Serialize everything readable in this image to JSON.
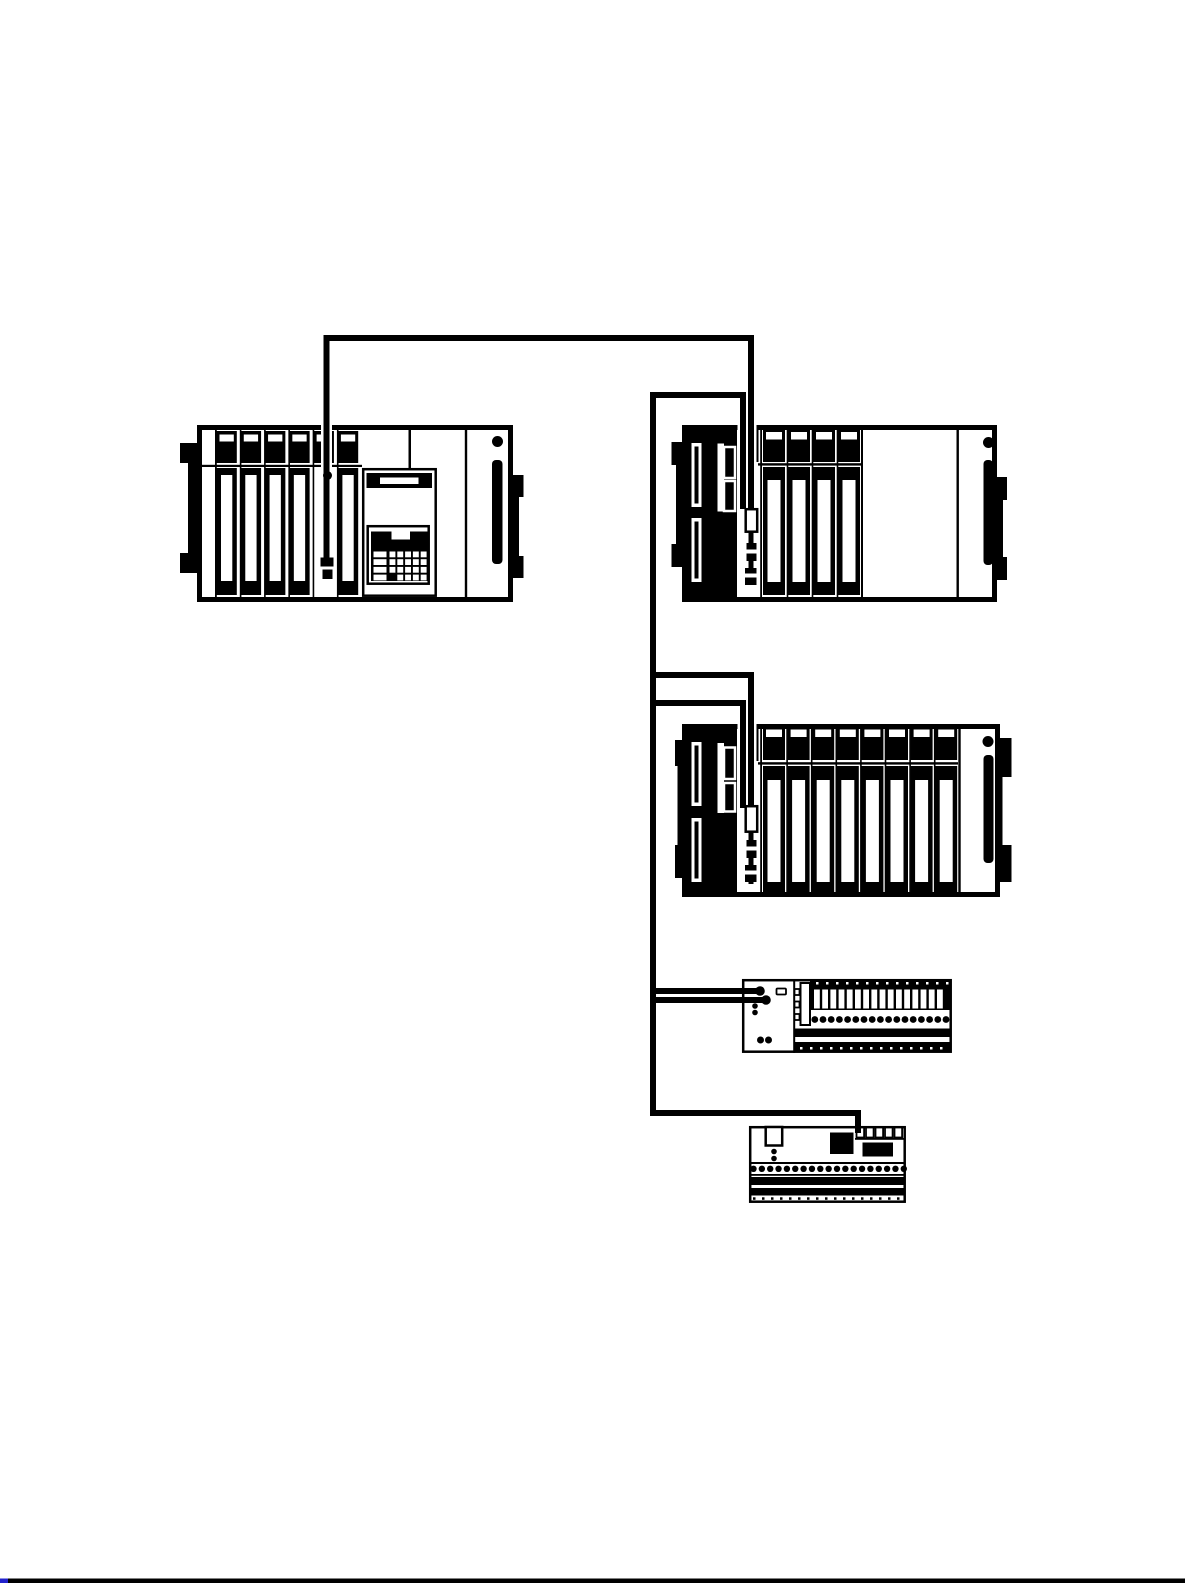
{
  "canvas": {
    "w": 1193,
    "h": 1585,
    "bg": "#ffffff",
    "ink": "#000000",
    "accent_blue": "#2222cc"
  },
  "figure": {
    "kind": "plc-network-wiring-diagram",
    "topology": "daisy-chain",
    "devices": [
      {
        "name": "plc-rack-with-programming-console",
        "module_slots": 6,
        "has_keypad": true,
        "has_display": true
      },
      {
        "name": "plc-expansion-rack-a",
        "module_slots": 4,
        "has_cpu_block": true
      },
      {
        "name": "plc-expansion-rack-b",
        "module_slots": 8,
        "has_cpu_block": true
      },
      {
        "name": "remote-io-terminal-block",
        "terminal_slots": 16,
        "terminal_screws": 17,
        "connection_terminals": 2
      },
      {
        "name": "remote-io-relay-board",
        "top_terminals": 5,
        "terminal_screws": 19
      }
    ],
    "cable_connection_dots": 3,
    "page_rule": {
      "color": "#000000",
      "left_tip_color": "#2222cc"
    }
  },
  "render_jobs": [
    {
      "target": "g-rack1-gen",
      "name": "slot-divider",
      "kind": "rects",
      "x0": 239.8,
      "y0": 430,
      "dx": 24.28,
      "count": 5,
      "w": 1.6,
      "h": 167
    },
    {
      "target": "g-rack1-gen",
      "name": "io-module-top",
      "kind": "rects",
      "x0": 216.5,
      "y0": 431,
      "dx": 24.28,
      "count": 6,
      "w": 20.3,
      "h": 32
    },
    {
      "target": "g-rack1-gen",
      "name": "io-module-top-label",
      "kind": "rects",
      "x0": 219.5,
      "y0": 434.5,
      "dx": 24.28,
      "count": 6,
      "w": 14.3,
      "h": 7,
      "fill": "#ffffff"
    },
    {
      "target": "g-rack1-gen",
      "name": "io-module-card",
      "kind": "rects",
      "x0": 216.5,
      "y0": 468,
      "dx": 24.28,
      "count": 6,
      "w": 20.3,
      "h": 127,
      "skip": [
        4
      ]
    },
    {
      "target": "g-rack1-gen",
      "name": "io-module-card-stripe",
      "kind": "rects",
      "x0": 221,
      "y0": 475,
      "dx": 24.28,
      "count": 6,
      "w": 11.3,
      "h": 106,
      "fill": "#ffffff",
      "skip": [
        4
      ]
    },
    {
      "target": "g-rack1-keys",
      "name": "keypad-key-wide",
      "kind": "rects",
      "x0": 373.5,
      "y0": 551.5,
      "dy": 7.7,
      "count": 4,
      "w": 13,
      "h": 5.8,
      "fill": "#ffffff"
    },
    {
      "target": "g-rack1-keys",
      "name": "keypad-key",
      "kind": "rects",
      "x0": 389.5,
      "y0": 551.5,
      "dx": 7.8,
      "count": 5,
      "w": 5.9,
      "h": 5.8,
      "fill": "#ffffff"
    },
    {
      "target": "g-rack1-keys",
      "name": "keypad-key",
      "kind": "rects",
      "x0": 389.5,
      "y0": 559.2,
      "dx": 7.8,
      "count": 5,
      "w": 5.9,
      "h": 5.8,
      "fill": "#ffffff"
    },
    {
      "target": "g-rack1-keys",
      "name": "keypad-key",
      "kind": "rects",
      "x0": 389.5,
      "y0": 566.9,
      "dx": 7.8,
      "count": 5,
      "w": 5.9,
      "h": 5.8,
      "fill": "#ffffff"
    },
    {
      "target": "g-rack1-keys",
      "name": "keypad-key",
      "kind": "rects",
      "x0": 389.5,
      "y0": 574.6,
      "dx": 7.8,
      "count": 5,
      "w": 5.9,
      "h": 5.8,
      "fill": "#ffffff",
      "skip": [
        0
      ]
    },
    {
      "target": "g-rack2-gen",
      "name": "slot-divider",
      "kind": "rects",
      "x0": 786.7,
      "y0": 430,
      "dx": 25,
      "count": 3,
      "w": 1.6,
      "h": 167
    },
    {
      "target": "g-rack2-gen",
      "name": "io-module-top",
      "kind": "rects",
      "x0": 763,
      "y0": 429.5,
      "dx": 25,
      "count": 4,
      "w": 22,
      "h": 32.5
    },
    {
      "target": "g-rack2-gen",
      "name": "io-module-top-label",
      "kind": "rects",
      "x0": 766,
      "y0": 432,
      "dx": 25,
      "count": 4,
      "w": 16,
      "h": 7.5,
      "fill": "#ffffff"
    },
    {
      "target": "g-rack2-gen",
      "name": "io-module-card",
      "kind": "rects",
      "x0": 763,
      "y0": 467,
      "dx": 25,
      "count": 4,
      "w": 22,
      "h": 128
    },
    {
      "target": "g-rack2-gen",
      "name": "io-module-card-stripe",
      "kind": "rects",
      "x0": 767.5,
      "y0": 480,
      "dx": 25,
      "count": 4,
      "w": 13,
      "h": 102,
      "fill": "#ffffff"
    },
    {
      "target": "g-rack3-gen",
      "name": "slot-divider",
      "kind": "rects",
      "x0": 786.3,
      "y0": 727,
      "dx": 24.6,
      "count": 7,
      "w": 1.6,
      "h": 166
    },
    {
      "target": "g-rack3-gen",
      "name": "io-module-top",
      "kind": "rects",
      "x0": 763,
      "y0": 726.5,
      "dx": 24.6,
      "count": 8,
      "w": 22,
      "h": 33.5
    },
    {
      "target": "g-rack3-gen",
      "name": "io-module-top-label",
      "kind": "rects",
      "x0": 766,
      "y0": 729.5,
      "dx": 24.6,
      "count": 8,
      "w": 16,
      "h": 7.5,
      "fill": "#ffffff"
    },
    {
      "target": "g-rack3-gen",
      "name": "io-module-card",
      "kind": "rects",
      "x0": 763,
      "y0": 766,
      "dx": 24.6,
      "count": 8,
      "w": 22,
      "h": 127
    },
    {
      "target": "g-rack3-gen",
      "name": "io-module-card-stripe",
      "kind": "rects",
      "x0": 767.5,
      "y0": 780,
      "dx": 24.6,
      "count": 8,
      "w": 13,
      "h": 102,
      "fill": "#ffffff"
    },
    {
      "target": "g-io-gen",
      "name": "terminal-slot",
      "kind": "rects",
      "x0": 814,
      "y0": 989.5,
      "dx": 8.2,
      "count": 16,
      "w": 5.8,
      "h": 19,
      "fill": "#ffffff"
    },
    {
      "target": "g-io-gen",
      "name": "tick-mark",
      "kind": "rects",
      "x0": 816,
      "y0": 982,
      "dx": 10,
      "count": 14,
      "w": 2.5,
      "h": 2.5,
      "fill": "#ffffff"
    },
    {
      "target": "g-io-gen",
      "name": "terminal-screw",
      "kind": "circles",
      "x0": 814.8,
      "cy": 1019.5,
      "dx": 8.2,
      "count": 17,
      "r": 3.4
    },
    {
      "target": "g-io-gen",
      "name": "tick-mark",
      "kind": "rects",
      "x0": 800,
      "y0": 1047,
      "dx": 10,
      "count": 15,
      "w": 2.5,
      "h": 2.5,
      "fill": "#ffffff"
    },
    {
      "target": "g-bd-gen",
      "name": "terminal-box",
      "kind": "rects",
      "x0": 856.5,
      "y0": 1127.5,
      "dx": 9.5,
      "count": 5,
      "w": 7.6,
      "h": 10,
      "fill": "#ffffff",
      "stroke": "#000000",
      "sw": 1.8
    },
    {
      "target": "g-bd-gen",
      "name": "terminal-screw",
      "kind": "circles",
      "x0": 753.5,
      "cy": 1168.8,
      "dx": 8.35,
      "count": 19,
      "r": 3.2
    },
    {
      "target": "g-bd-gen",
      "name": "tick-mark",
      "kind": "rects",
      "x0": 753,
      "y0": 1197.3,
      "dx": 9,
      "count": 17,
      "w": 2.5,
      "h": 2.5
    },
    {
      "target": "g-wires-under",
      "name": "cable-halo",
      "kind": "wires",
      "sw": 11,
      "lines": [
        {
          "pts": [
            [
              326.5,
              424
            ],
            [
              326.5,
              561
            ]
          ],
          "color": "#ffffff"
        },
        {
          "pts": [
            [
              743,
              423
            ],
            [
              743,
              509
            ]
          ],
          "color": "#ffffff"
        },
        {
          "pts": [
            [
              751,
              423
            ],
            [
              751,
              509
            ]
          ],
          "color": "#ffffff"
        },
        {
          "pts": [
            [
              743,
              722
            ],
            [
              743,
              807
            ]
          ],
          "color": "#ffffff"
        },
        {
          "pts": [
            [
              751,
              722
            ],
            [
              751,
              807
            ]
          ],
          "color": "#ffffff"
        }
      ]
    },
    {
      "target": "g-wires",
      "name": "network-cable",
      "kind": "wires",
      "sw": 6,
      "lines": [
        {
          "name": "cable-rack1-to-rack2",
          "pts": [
            [
              326.5,
              559
            ],
            [
              326.5,
              338
            ],
            [
              751,
              338
            ],
            [
              751,
              510
            ]
          ]
        },
        {
          "name": "cable-rack2-out",
          "pts": [
            [
              743,
              509
            ],
            [
              743,
              395
            ],
            [
              650,
              395
            ]
          ]
        },
        {
          "name": "cable-trunk",
          "pts": [
            [
              653,
              392
            ],
            [
              653,
              1113
            ],
            [
              858,
              1113
            ],
            [
              858,
              1133
            ]
          ]
        },
        {
          "name": "cable-rack3-in",
          "pts": [
            [
              650,
              675
            ],
            [
              751,
              675
            ],
            [
              751,
              808
            ]
          ]
        },
        {
          "name": "cable-rack3-out",
          "pts": [
            [
              743,
              808
            ],
            [
              743,
              703
            ],
            [
              650,
              703
            ]
          ]
        },
        {
          "name": "cable-io-in",
          "pts": [
            [
              650,
              991
            ],
            [
              757,
              991
            ]
          ]
        },
        {
          "name": "cable-io-out",
          "pts": [
            [
              763,
              1000
            ],
            [
              650,
              1000
            ]
          ]
        }
      ]
    },
    {
      "target": "g-wire-dots",
      "name": "connection-terminal-dot",
      "kind": "dots",
      "points": [
        [
          327.5,
          475.5,
          4.5
        ],
        [
          760,
          991,
          4.8
        ],
        [
          766,
          1000,
          4.8
        ]
      ]
    }
  ]
}
